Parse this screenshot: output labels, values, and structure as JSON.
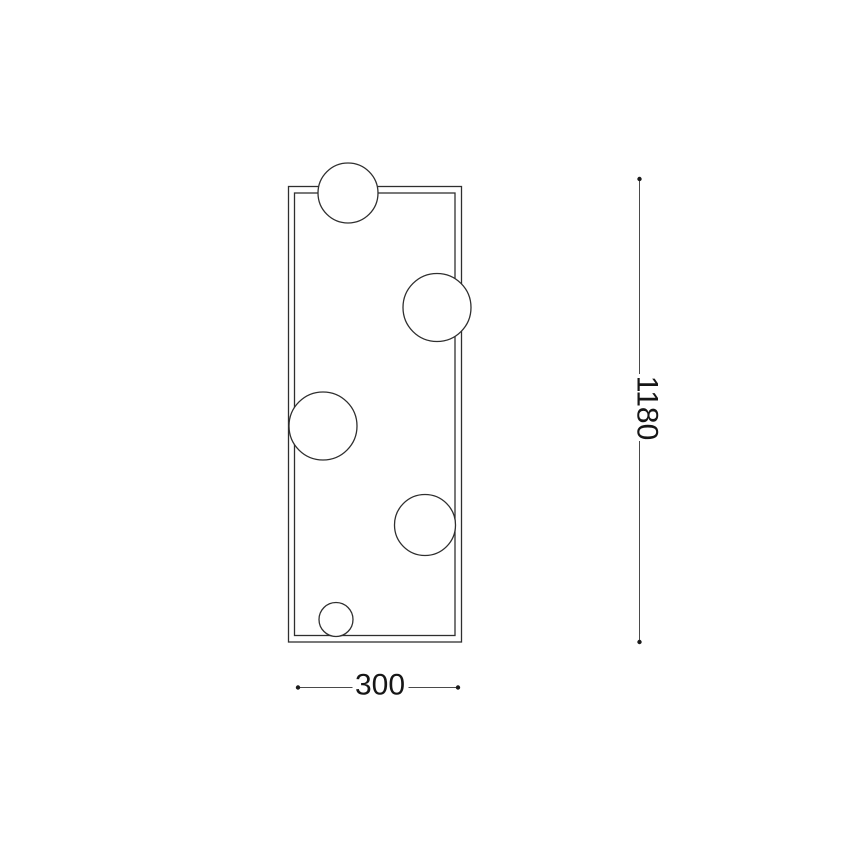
{
  "drawing": {
    "kind": "technical dimension drawing of rectangular frame fixture with 5 spheres",
    "sphere_count": 5,
    "dimensions": {
      "height": {
        "label": "1180",
        "value": 1180
      },
      "width": {
        "label": "300",
        "value": 300
      }
    },
    "colors": {
      "outline": "#2f2f2f",
      "dimension_line": "#4a4a4a",
      "text": "#161616",
      "background": "#ffffff"
    }
  }
}
